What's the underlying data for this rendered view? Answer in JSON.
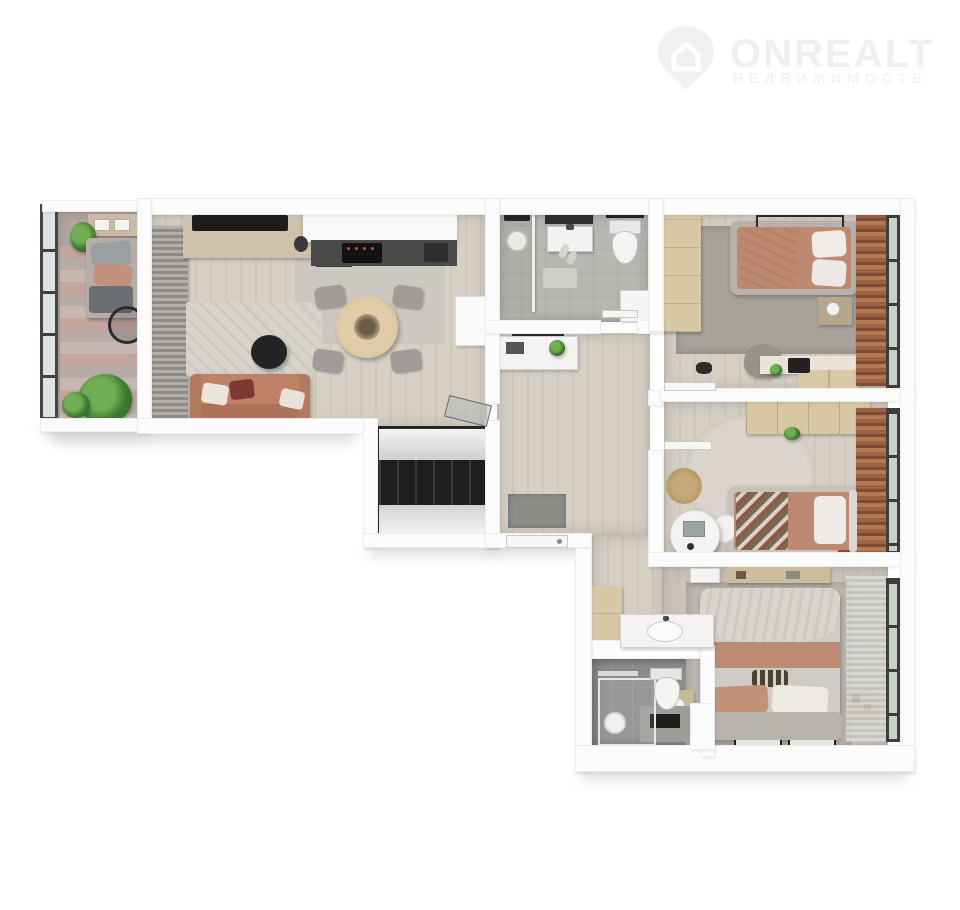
{
  "watermark": {
    "brand": "ONREALT",
    "tagline": "НЕДВИЖИМОСТЬ",
    "icon": "location-pin-house-icon",
    "color": "#f0f0f0"
  },
  "plan": {
    "type": "apartment-floor-plan-3d-top-view",
    "rooms": [
      "balcony",
      "living-room",
      "kitchen",
      "bathroom",
      "hallway",
      "built-in-wardrobe",
      "bedroom-1",
      "bedroom-2",
      "entrance-corridor",
      "master-bedroom",
      "second-bathroom"
    ]
  },
  "palette": {
    "background": "#ffffff",
    "wall": "#fcfcfc",
    "wood_floor": "#d6cfc4",
    "gray_tile": "#b8b7b3",
    "dark_tile": "#8d8d8b",
    "terracotta_sofa": "#bf8165",
    "salmon_bedding": "#bd8a71",
    "terracotta_curtain": "#9d6143",
    "wood_furniture": "#d8c7a4",
    "light_rug": "#d9d4cb",
    "gray_rug": "#a7a29c",
    "dark_accent": "#262626",
    "plant_green": "#4e8f3c"
  }
}
